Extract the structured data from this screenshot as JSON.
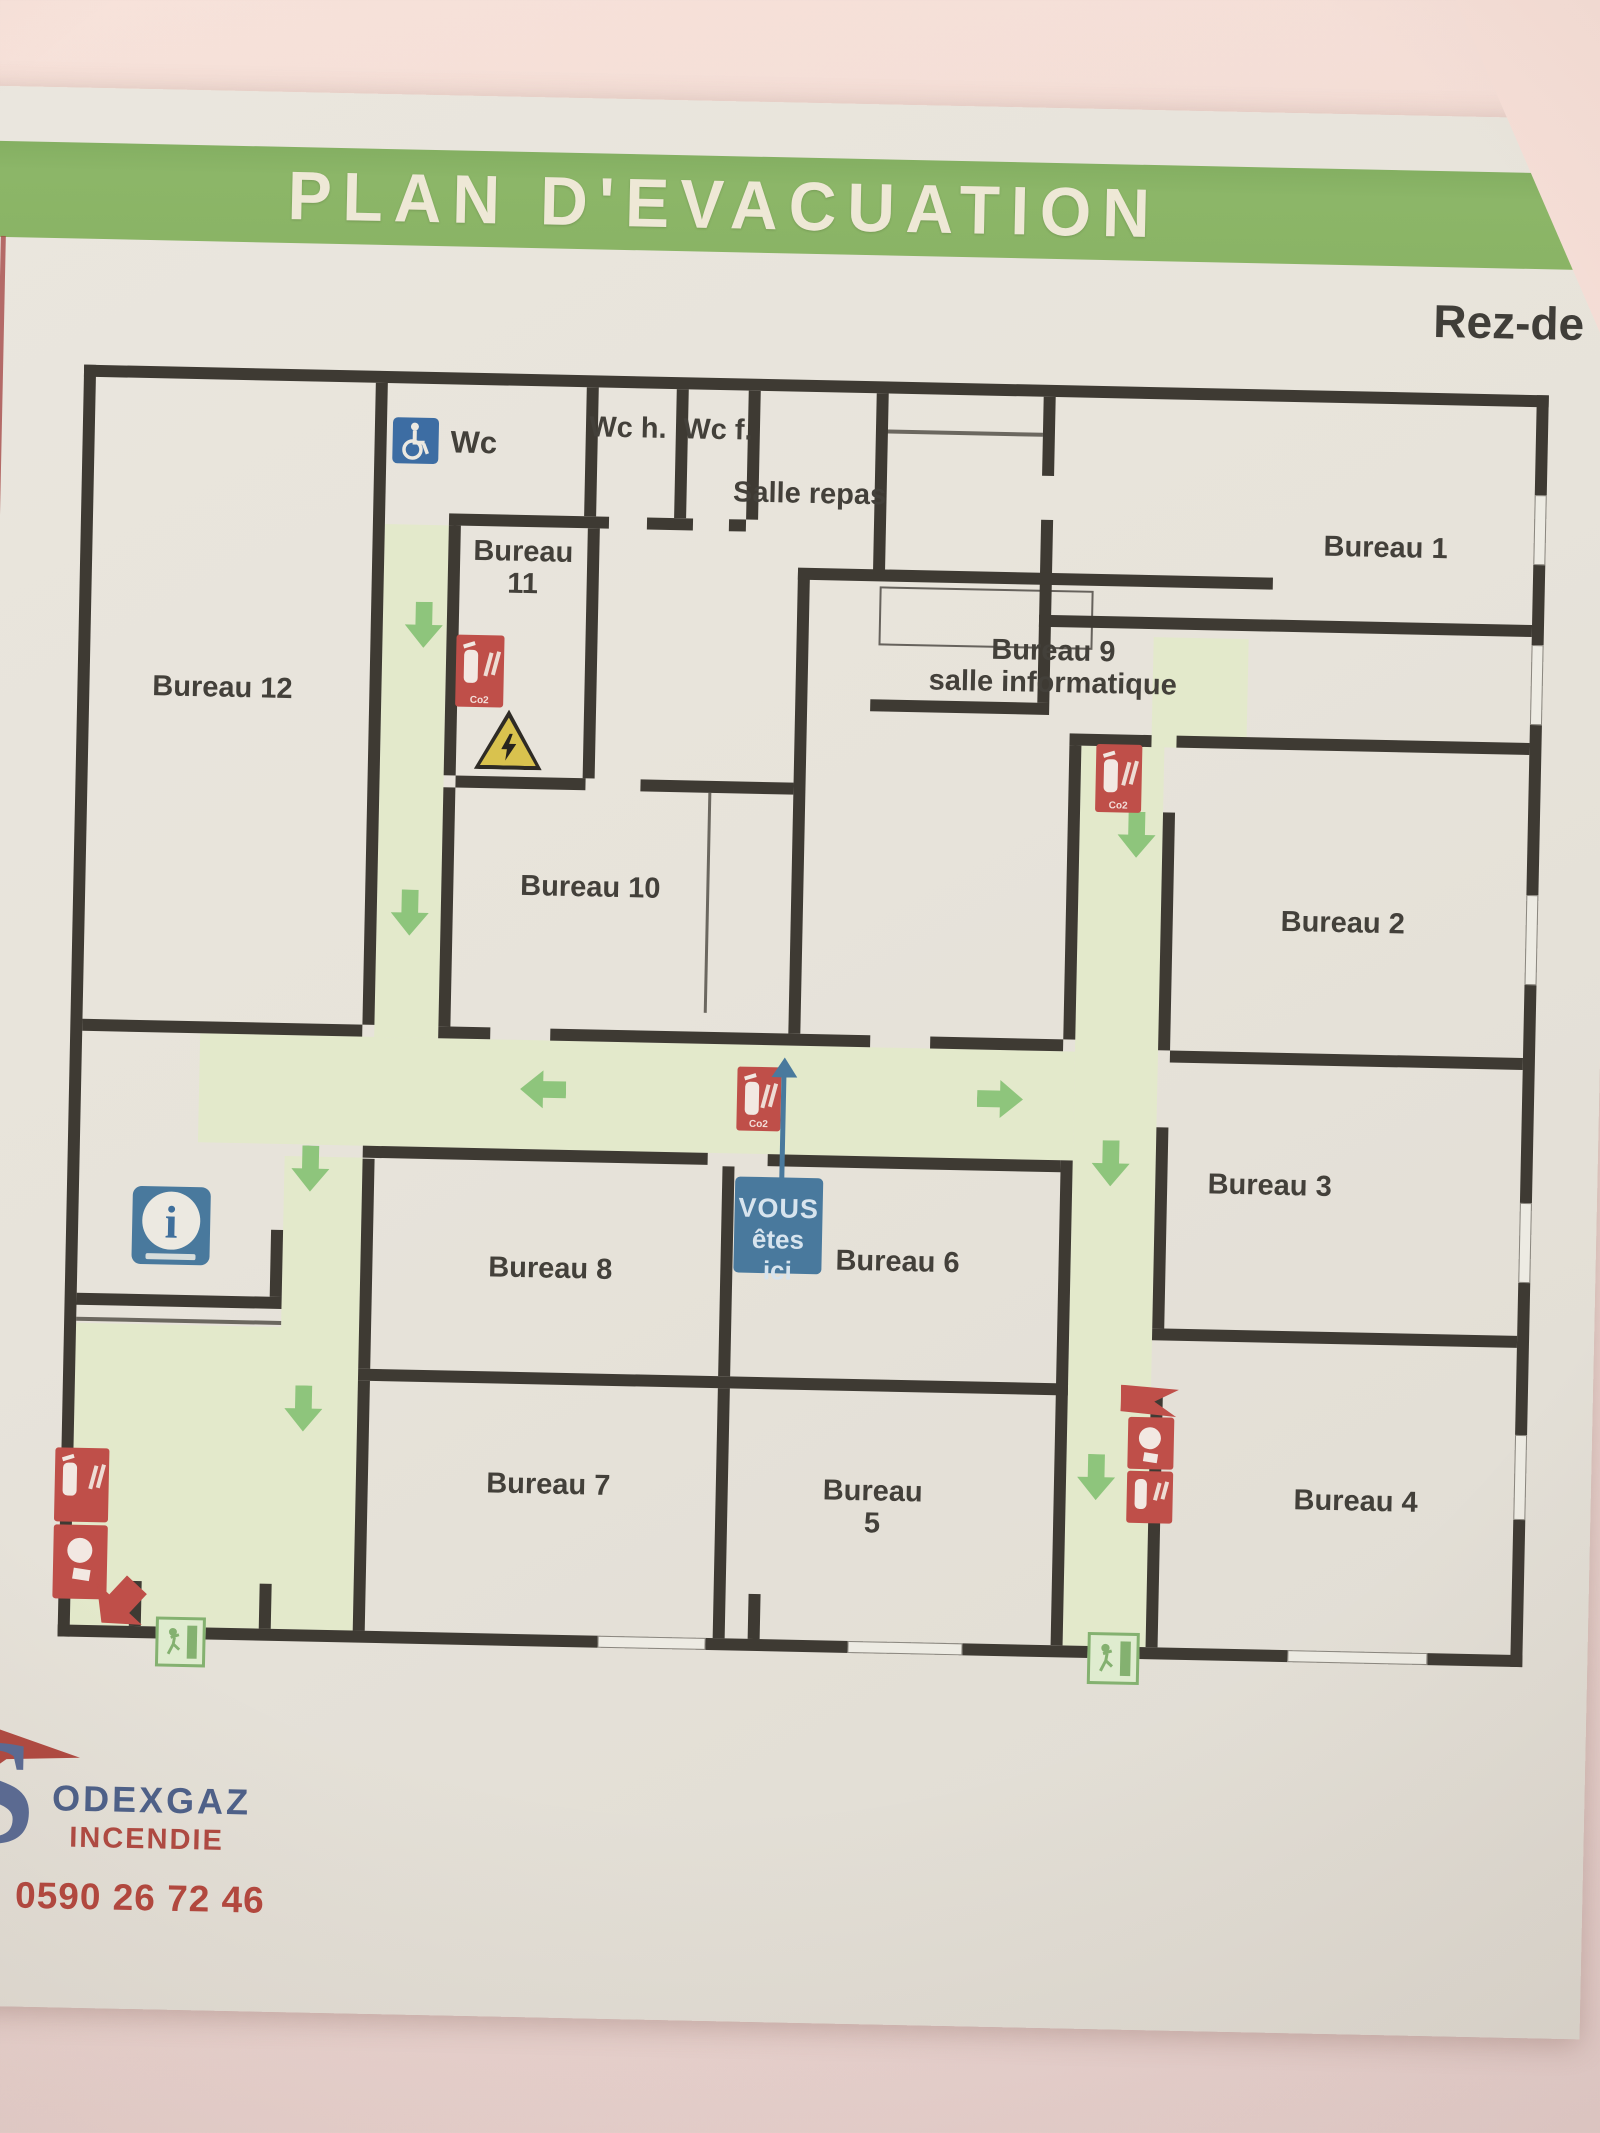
{
  "header": {
    "title": "PLAN D'EVACUATION",
    "floor_label": "Rez-de"
  },
  "rooms": [
    {
      "id": "bureau-12",
      "label": "Bureau 12"
    },
    {
      "id": "wc-handicap",
      "label": "Wc"
    },
    {
      "id": "wc-hommes",
      "label": "Wc h."
    },
    {
      "id": "wc-femmes",
      "label": "Wc f."
    },
    {
      "id": "salle-repas",
      "label": "Salle repas"
    },
    {
      "id": "bureau-11",
      "label": "Bureau",
      "label2": "11"
    },
    {
      "id": "bureau-1",
      "label": "Bureau 1"
    },
    {
      "id": "bureau-10",
      "label": "Bureau 10"
    },
    {
      "id": "bureau-9",
      "label": "Bureau 9",
      "label2": "salle informatique"
    },
    {
      "id": "bureau-2",
      "label": "Bureau 2"
    },
    {
      "id": "bureau-3",
      "label": "Bureau 3"
    },
    {
      "id": "bureau-4",
      "label": "Bureau 4"
    },
    {
      "id": "bureau-8",
      "label": "Bureau 8"
    },
    {
      "id": "bureau-6",
      "label": "Bureau 6"
    },
    {
      "id": "bureau-7",
      "label": "Bureau 7"
    },
    {
      "id": "bureau-5",
      "label": "Bureau 5"
    }
  ],
  "marker": {
    "line1": "VOUS",
    "line2": "êtes ici"
  },
  "icons": {
    "extinguisher": "fire-extinguisher",
    "extinguisher_caption": "Co2",
    "manual_alarm": "manual-fire-alarm",
    "exit": "emergency-exit-running-man",
    "info": "information-point",
    "wheelchair": "accessible-wc",
    "hazard": "electrical-hazard",
    "you_are_here": "you-are-here-marker",
    "route_arrow": "evacuation-route-arrow"
  },
  "logo": {
    "initial": "S",
    "company": "ODEXGAZ",
    "line2": "INCENDIE",
    "phone": "Tél: 0590 26 72 46"
  },
  "colors": {
    "header_green": "#8cb668",
    "wall_dark": "#3e3a33",
    "route_green": "#e3e9cb",
    "arrow_green": "#8ec57c",
    "safety_red": "#bf4f49",
    "info_blue": "#49799d",
    "exit_green": "#84b170",
    "hazard_yellow": "#d9c24e",
    "logo_blue": "#4d6089",
    "logo_red": "#b04a41",
    "paper": "#e7e3da",
    "photo_wall_pink": "#f2dad3"
  }
}
